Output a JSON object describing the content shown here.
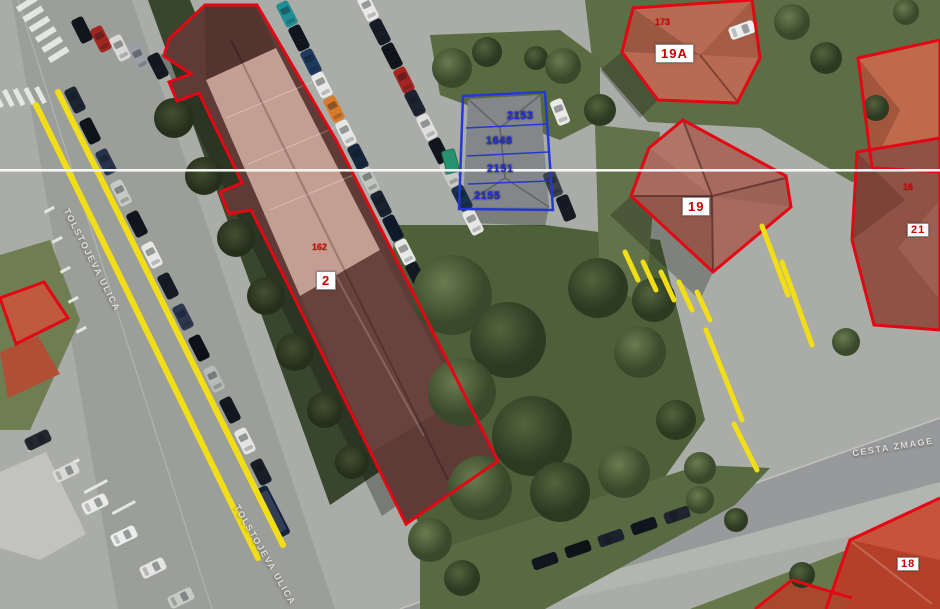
{
  "map": {
    "street_labels": [
      {
        "text": "TOLSTOJEVA ULICA"
      },
      {
        "text": "TOLSTOJEVA ULICA"
      },
      {
        "text": "CESTA ZMAGE"
      }
    ],
    "building_number_boxes": [
      "2",
      "19",
      "19A",
      "21",
      "18"
    ],
    "parcel_numbers": [
      "2153",
      "1648",
      "2151",
      "2155"
    ],
    "small_building_numbers": [
      "162",
      "173",
      "16"
    ],
    "colors": {
      "cadastral_outline_red": "#e30613",
      "parcel_outline_blue": "#2438d2",
      "road_marking_yellow": "#f2de16",
      "survey_line_white": "#fbfbfb",
      "label_text_red": "#c40000",
      "parcel_text_blue": "#2531d8"
    }
  }
}
